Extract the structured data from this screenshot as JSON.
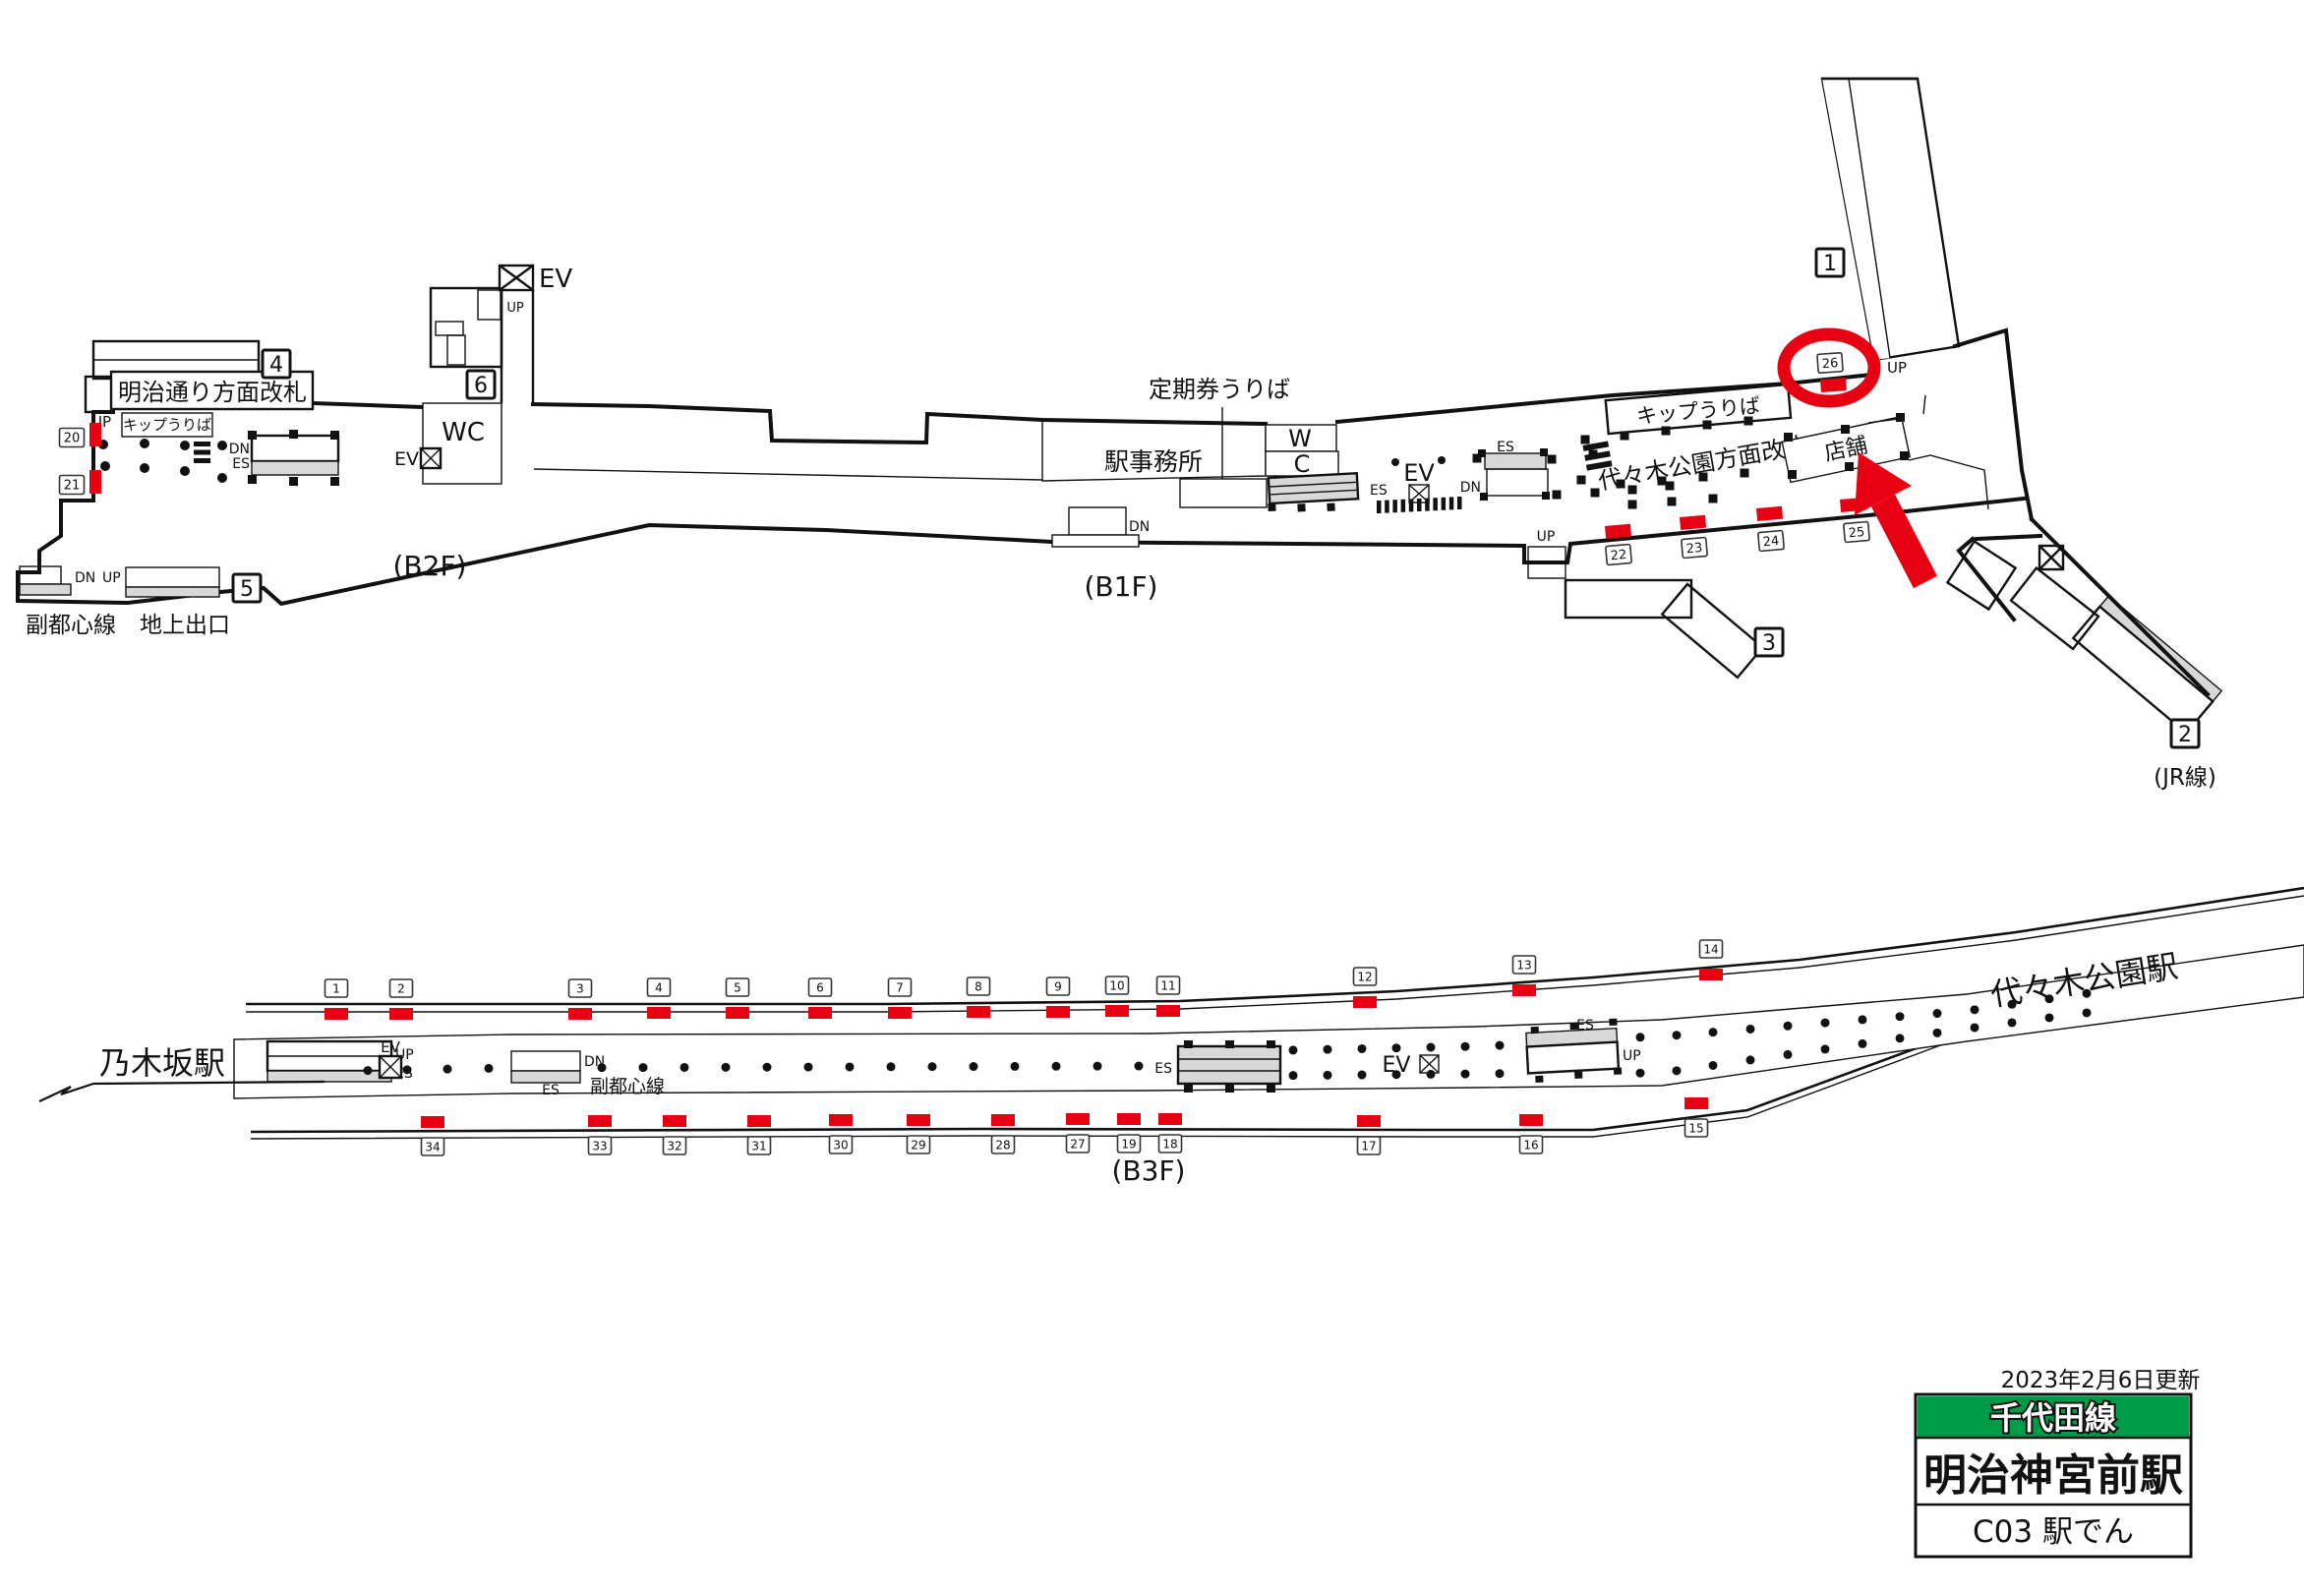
{
  "sign": {
    "updated": "2023年2月6日更新",
    "line_name": "千代田線",
    "station_name": "明治神宮前駅",
    "code_row": "C03 駅でん"
  },
  "adjacent_stations": {
    "left": "乃木坂駅",
    "right": "代々木公園駅"
  },
  "floors": {
    "b2f": "(B2F)",
    "b1f": "(B1F)",
    "b3f": "(B3F)"
  },
  "labels": {
    "up": "UP",
    "dn": "DN",
    "es": "ES",
    "ev": "EV",
    "wc": "WC",
    "w": "W",
    "c": "C",
    "meiji_gate": "明治通り方面改札",
    "ticket_office": "キップうりば",
    "commuter_pass": "定期券うりば",
    "station_office": "駅事務所",
    "yoyogi_gate": "代々木公園方面改札",
    "shop": "店舗",
    "fukutoshin": "副都心線",
    "ground_exit": "地上出口",
    "jr": "(JR線)"
  },
  "exits": {
    "e1": "1",
    "e2": "2",
    "e3": "3",
    "e4": "4",
    "e5": "5",
    "e6": "6"
  },
  "ad_positions": {
    "concourse": [
      "20",
      "21",
      "22",
      "23",
      "24",
      "25",
      "26"
    ],
    "platform_top": [
      "1",
      "2",
      "3",
      "4",
      "5",
      "6",
      "7",
      "8",
      "9",
      "10",
      "11",
      "12",
      "13",
      "14"
    ],
    "platform_bottom": [
      "34",
      "33",
      "32",
      "31",
      "30",
      "29",
      "28",
      "27",
      "19",
      "18",
      "17",
      "16",
      "15"
    ]
  },
  "highlight": {
    "circled_position": "26",
    "arrow_points_to": "店舗"
  },
  "colors": {
    "marker_red": "#e60012",
    "line_green": "#009b49"
  }
}
